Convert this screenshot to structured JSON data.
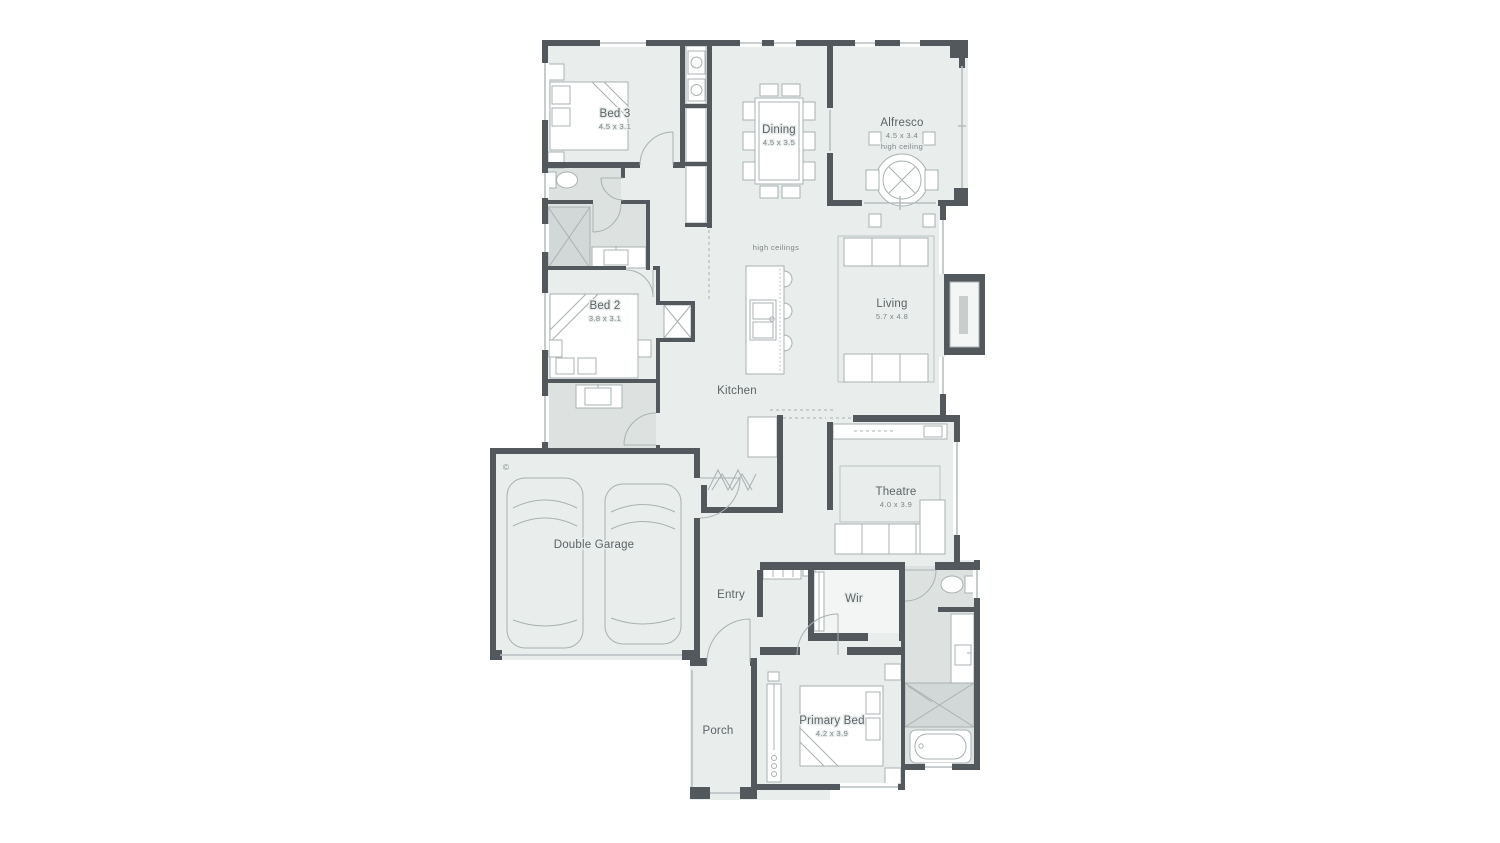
{
  "plan": {
    "copyright_symbol": "©",
    "annotations": {
      "open_area": "high ceilings"
    },
    "rooms": {
      "bed3": {
        "label": "Bed 3",
        "dims": "4.5 x 3.1"
      },
      "dining": {
        "label": "Dining",
        "dims": "4.5 x 3.5"
      },
      "alfresco": {
        "label": "Alfresco",
        "dims": "4.5 x 3.4",
        "note": "high ceiling"
      },
      "living": {
        "label": "Living",
        "dims": "5.7 x 4.8"
      },
      "kitchen": {
        "label": "Kitchen"
      },
      "bed2": {
        "label": "Bed 2",
        "dims": "3.8 x 3.1"
      },
      "theatre": {
        "label": "Theatre",
        "dims": "4.0 x 3.9"
      },
      "garage": {
        "label": "Double Garage"
      },
      "entry": {
        "label": "Entry"
      },
      "wir": {
        "label": "Wir"
      },
      "primary": {
        "label": "Primary Bed",
        "dims": "4.2 x 3.9"
      },
      "porch": {
        "label": "Porch"
      }
    },
    "colors": {
      "wall": "#53585c",
      "floor": "#e9edec",
      "wet_area": "#dde2e1",
      "furniture_line": "#a9b1b2",
      "label_text": "#5c6266",
      "dim_text": "#7d8488",
      "background": "#ffffff"
    }
  }
}
